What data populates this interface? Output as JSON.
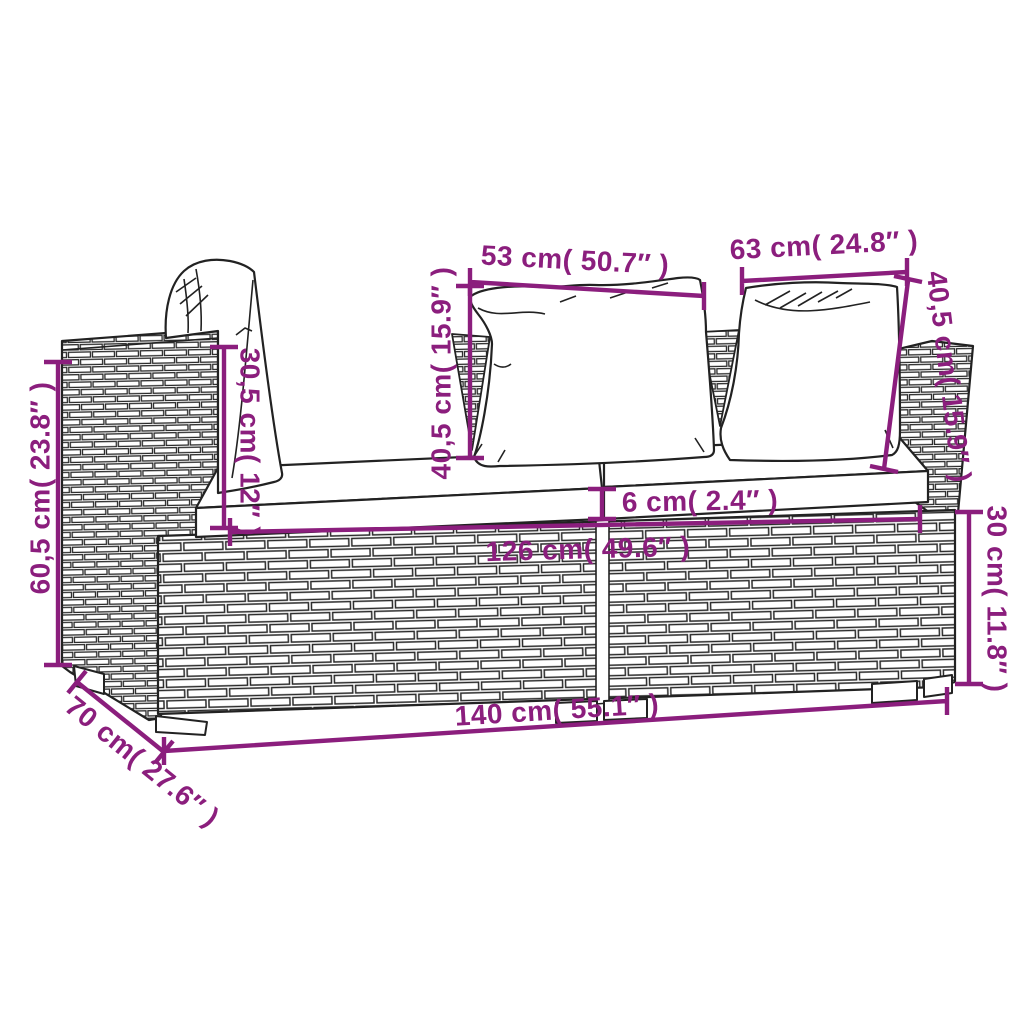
{
  "figure": {
    "type": "product-dimension-diagram",
    "subject": "2-seater poly rattan garden corner sofa with seat cushions and back pillows"
  },
  "colors": {
    "dimension": "#8b1e7d",
    "line_art": "#222222",
    "background": "#ffffff"
  },
  "measurements": {
    "pillow_width_center": {
      "label": "53 cm( 50.7″ )",
      "value_cm": 53,
      "value_in": 50.7
    },
    "pillow_width_right": {
      "label": "63 cm( 24.8″ )",
      "value_cm": 63,
      "value_in": 24.8
    },
    "pillow_height_center": {
      "label": "40,5 cm( 15.9″ )",
      "value_cm": 40.5,
      "value_in": 15.9
    },
    "pillow_height_right": {
      "label": "40,5 cm( 15.9″ )",
      "value_cm": 40.5,
      "value_in": 15.9
    },
    "backrest_above_seat": {
      "label": "30,5 cm( 12″ )",
      "value_cm": 30.5,
      "value_in": 12
    },
    "overall_height": {
      "label": "60,5 cm( 23.8″ )",
      "value_cm": 60.5,
      "value_in": 23.8
    },
    "cushion_thickness": {
      "label": "6 cm( 2.4″ )",
      "value_cm": 6,
      "value_in": 2.4
    },
    "inner_width": {
      "label": "126 cm( 49.6″ )",
      "value_cm": 126,
      "value_in": 49.6
    },
    "base_height": {
      "label": "30 cm( 11.8″ )",
      "value_cm": 30,
      "value_in": 11.8
    },
    "overall_width": {
      "label": "140 cm( 55.1″ )",
      "value_cm": 140,
      "value_in": 55.1
    },
    "depth": {
      "label": "70 cm( 27.6″ )",
      "value_cm": 70,
      "value_in": 27.6
    }
  }
}
